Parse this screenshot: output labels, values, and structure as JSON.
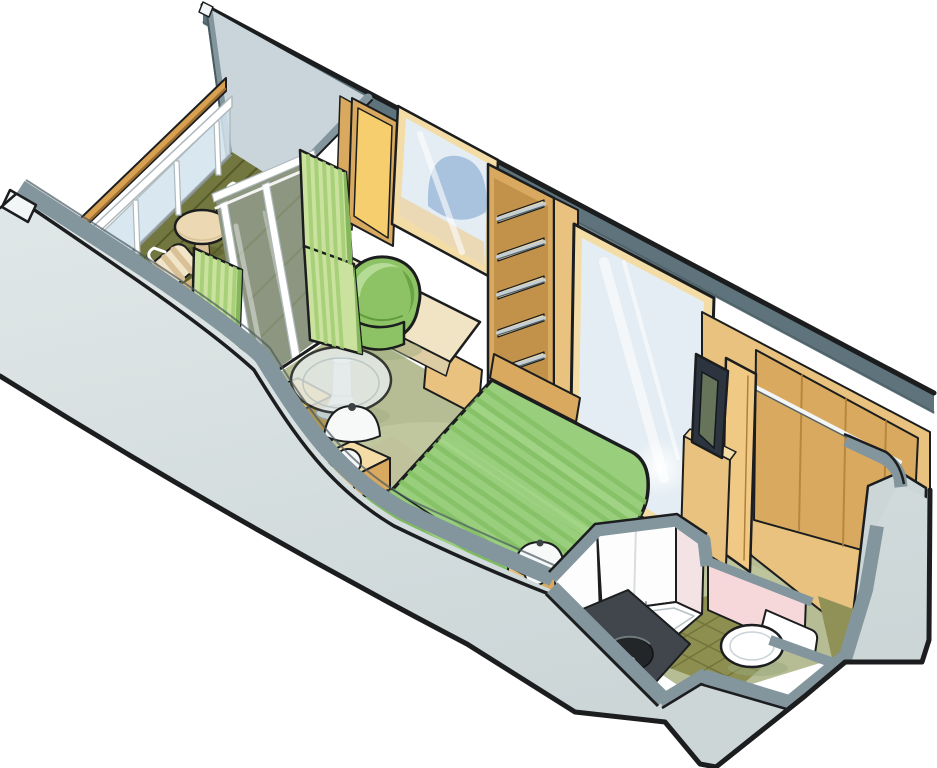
{
  "meta": {
    "title": "Cruise ship stateroom with private balcony — isometric cutaway floor plan illustration",
    "canvas_width": 937,
    "canvas_height": 768,
    "background": "#ffffff"
  },
  "palette": {
    "outline": "#1b1d1e",
    "band": "#83969e",
    "bandDark": "#5e737b",
    "bandShadow": "#4a5a61",
    "wallFace": "#ccd6d7",
    "wallFaceLight": "#e0e7e8",
    "wallCut": "#f3f6f6",
    "divider": "#c9d5da",
    "deck": "#72763f",
    "deckLine": "#555a28",
    "deckThrough": "#666c47",
    "deckWedge": "#d6b77c",
    "handrail": "#d8a152",
    "handrailDark": "#9e6f33",
    "white": "#ffffff",
    "railShadow": "#aeb9bd",
    "glass": "#d4e4ee",
    "curtain": "#cbe29e",
    "curtainStripe": "#a3cf74",
    "curtainDark": "#86b75c",
    "carpet": "#b6bd94",
    "carpetLight": "#cdd3ad",
    "carpetKhaki": "#b5b28a",
    "woodLight": "#f4dca6",
    "wood": "#e8c27e",
    "woodMid": "#d8a95f",
    "woodDark": "#b07f3a",
    "woodPale": "#f0ca85",
    "yellow": "#f6ce6e",
    "mirror": "#e4edf3",
    "mirrorBlue": "#a2bcdc",
    "mirrorBeige": "#ead9b4",
    "metal": "#c5ced2",
    "metalDark": "#55646b",
    "tub": "#8dc365",
    "tubLight": "#b5dc97",
    "tubDark": "#5f9c3c",
    "bed": "#98ce7c",
    "bedStripe": "#85c166",
    "bedHi": "#aedb92",
    "fold": "#7fba60",
    "foldStripe": "#9ad07d",
    "chairYellow": "#e8ba59",
    "chairYellowMid": "#d9a84e",
    "chairYellowDark": "#c08c38",
    "maroon": "#802f2c",
    "lamp": "#f7f9f9",
    "lampDark": "#3c4346",
    "glassTop": "#e7edec",
    "glassEdge": "#c2cfcf",
    "pedestal": "#dde4e3",
    "bathWhite": "#fdfdfd",
    "pinkSoft": "#f3e3e4",
    "pink": "#f6d8da",
    "counter": "#40464b",
    "sink": "#232628",
    "tile": "#8d8f50",
    "tileDark": "#70723a",
    "olive": "#8f9157",
    "toiletRim": "#c9d2d5",
    "tv": "#2c3440",
    "tvScreen": "#66755a",
    "chairStripeA": "#f1e5c8",
    "chairStripeB": "#d9c097",
    "tableCream": "#ecd9b4",
    "deskTop": "#f0e4c4",
    "deskEdge": "#decda4",
    "shadowGreen": "#9aa87c",
    "legGray": "#8b959a",
    "trayLine": "#b6c1c4",
    "showerGlassLine": "#9aa5a9"
  },
  "scene": {
    "areas": [
      "balcony",
      "bedroom",
      "bathroom",
      "wardrobe"
    ],
    "objects": [
      "balcony-railing",
      "balcony-deck",
      "balcony-table",
      "balcony-chair",
      "sliding-glass-door",
      "curtain",
      "divider-wall",
      "cutaway-front-wall",
      "vanity-mirror",
      "yellow-panel",
      "vanity-desk",
      "tub-chair",
      "open-shelf-unit",
      "full-height-mirror",
      "headboard",
      "double-bed",
      "nightstand",
      "table-lamp",
      "glass-cocktail-table",
      "armchair",
      "television",
      "tv-cabinet",
      "wardrobe-closet",
      "closet-rod",
      "shower-cabin",
      "shower-tray",
      "washbasin-counter",
      "toilet",
      "tile-floor"
    ]
  }
}
